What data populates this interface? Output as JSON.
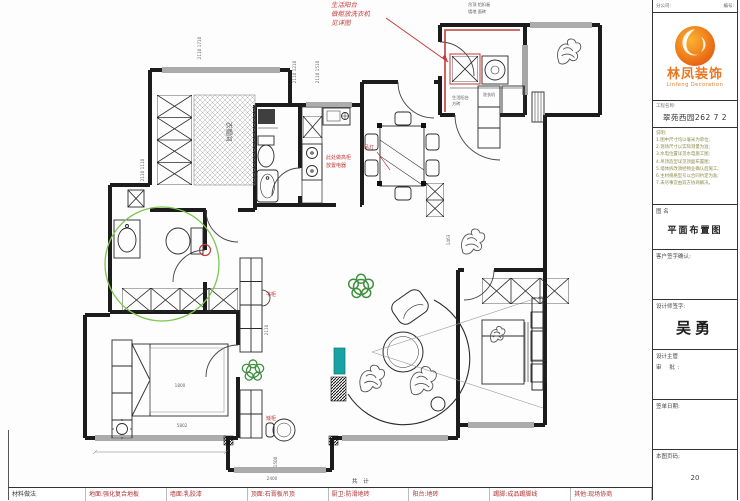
{
  "colors": {
    "annotation_red": "#c23b3b",
    "annotation_green": "#7cc74f",
    "accent_orange": "#e87722",
    "teal_furniture": "#16a3a3"
  },
  "plan": {
    "labels": {
      "cloakroom": "衣帽间",
      "laundry1": "生活阳台",
      "laundry2": "方砖",
      "washer": "洗衣机",
      "note_top1": "吊顶 铝扣板",
      "note_top2": "墙地 面砖"
    },
    "red_notes": {
      "hand1": "生活阳台",
      "hand2": "做柜放洗衣机",
      "hand3": "见详图",
      "kitchen1": "此处做高柜",
      "kitchen2": "放置电器",
      "dining": "吊灯",
      "study1": "书柜",
      "study2": "矮柜"
    },
    "dims": {
      "a": "2110 1710",
      "b": "2110 1210",
      "c": "2110 1510",
      "d": "1463",
      "e": "2110",
      "f": "1800",
      "g": "5802",
      "h": "2400",
      "i": "1500",
      "j": "2110 1110"
    }
  },
  "titleblock": {
    "header_left": "分公司:",
    "header_right": "编号:",
    "company_cn": "林凤装饰",
    "company_en": "Linfeng Decoration",
    "project_label": "工程名称:",
    "project_value": "翠苑西园262 7 2",
    "notes_lines": [
      "说明:",
      "1.图中尺寸均以毫米为单位;",
      "2.现场尺寸以实际测量为准;",
      "3.水电位置详见水电施工图;",
      "4.吊顶造型详见顶面布置图;",
      "5.墙体拆改须经物业确认后施工;",
      "6.主材规格型号以合同约定为准;",
      "7.未尽事宜由双方协商解决。"
    ],
    "drawing_label": "图  名",
    "drawing_value": "平面布置图",
    "customer_label": "客户签字确认:",
    "designer_label": "设计师签字:",
    "designer_value": "吴勇",
    "supervisor_label": "设计主管",
    "audit_label": "审 批:",
    "date_label": "签单日期:",
    "page_label": "本图页码:",
    "page_value": "20"
  },
  "legend": {
    "total": "共 计",
    "items": [
      "材料做法",
      "地面:强化复合地板",
      "墙面:乳胶漆",
      "顶面:石膏板吊顶",
      "厨卫:防滑地砖",
      "阳台:地砖",
      "踢脚:成品踢脚线",
      "其他:现场协商"
    ]
  }
}
